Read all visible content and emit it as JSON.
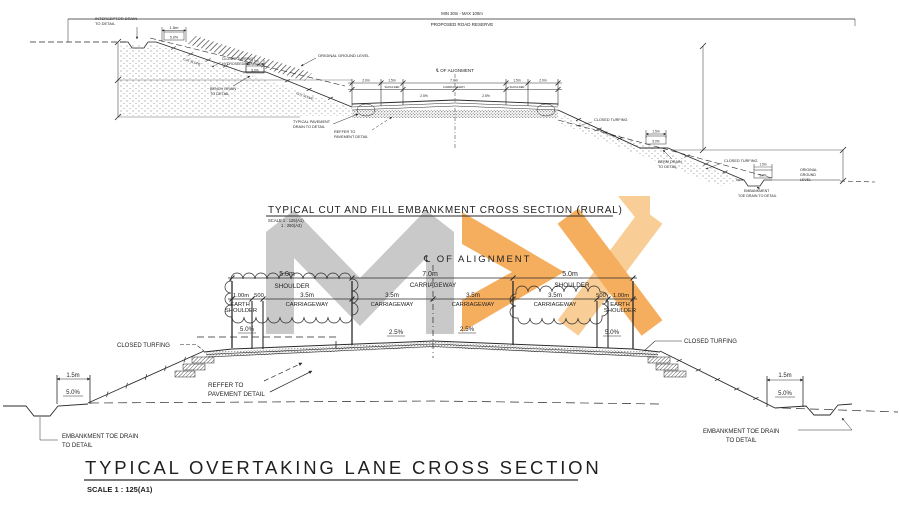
{
  "watermark": {
    "gray": "#c9c9c9",
    "orange": "#f5ad5e",
    "orange_light": "#f9cd96"
  },
  "top_diagram": {
    "title": "TYPICAL CUT AND FILL EMBANKMENT CROSS SECTION (RURAL)",
    "scale_line_1": "SCALE 1 : 125(A1)",
    "scale_line_2": "1 : 250(A3)",
    "road_reserve_dim": "MIN 30m - MAX 100m",
    "road_reserve_label": "PROPOSED ROAD RESERVE",
    "centerline_label": "℄ OF ALIGNMENT",
    "interceptor_drain_line_1": "INTERCEPTOR DRAIN",
    "interceptor_drain_line_2": "TO DETAIL",
    "original_ground_label": "ORIGINAL GROUND LEVEL",
    "closed_turfing_hydroseeding_line_1": "CLOSED TURFING /",
    "closed_turfing_hydroseeding_line_2": "HYDROSEEDING",
    "cut_slope_label": "CUT SLOPE",
    "bench_drain_line_1": "BENCH DRAIN",
    "bench_drain_line_2": "TO DETAIL",
    "typical_pavement_drain_line_1": "TYPICAL PAVEMENT",
    "typical_pavement_drain_line_2": "DRAIN TO DETAIL",
    "reffer_line_1": "REFFER TO",
    "reffer_line_2": "PAVEMENT DETAIL",
    "fill_slope_label": "FILL SLOPE",
    "closed_turfing_label": "CLOSED TURFING",
    "berm_drain_line_1": "BERM DRAIN",
    "berm_drain_line_2": "TO DETAIL",
    "original_ground_right_line_1": "ORIGINAL",
    "original_ground_right_line_2": "GROUND",
    "original_ground_right_line_3": "LEVEL",
    "embankment_toe_line_1": "EMBANKMENT",
    "embankment_toe_line_2": "TOE DRAIN TO DETAIL",
    "dims": {
      "d_1_5m": "1.5m",
      "d_2_0m": "2.0m",
      "d_7_0m": "7.0m",
      "pct_5": "5.0%",
      "pct_2_5": "2.5%",
      "shoulder": "SHOULDER",
      "carriageway": "CARRIAGEWAY"
    }
  },
  "bottom_diagram": {
    "title": "TYPICAL OVERTAKING LANE CROSS SECTION",
    "scale": "SCALE 1 : 125(A1)",
    "centerline_label": "℄ OF ALIGNMENT",
    "dims": {
      "d_5_0m": "5.0m",
      "d_7_0m": "7.0m",
      "d_3_5m": "3.5m",
      "d_1_00m": "1.00m",
      "d_500": "500",
      "d_1_5m": "1.5m",
      "pct_5": "5.0%",
      "pct_2_5": "2.5%"
    },
    "labels": {
      "shoulder": "SHOULDER",
      "carriageway": "CARRIAGEWAY",
      "earth": "EARTH",
      "closed_turfing": "CLOSED TURFING",
      "reffer_line_1": "REFFER TO",
      "reffer_line_2": "PAVEMENT DETAIL",
      "toe_line_1": "EMBANKMENT TOE DRAIN",
      "toe_line_2": "TO DETAIL"
    }
  }
}
